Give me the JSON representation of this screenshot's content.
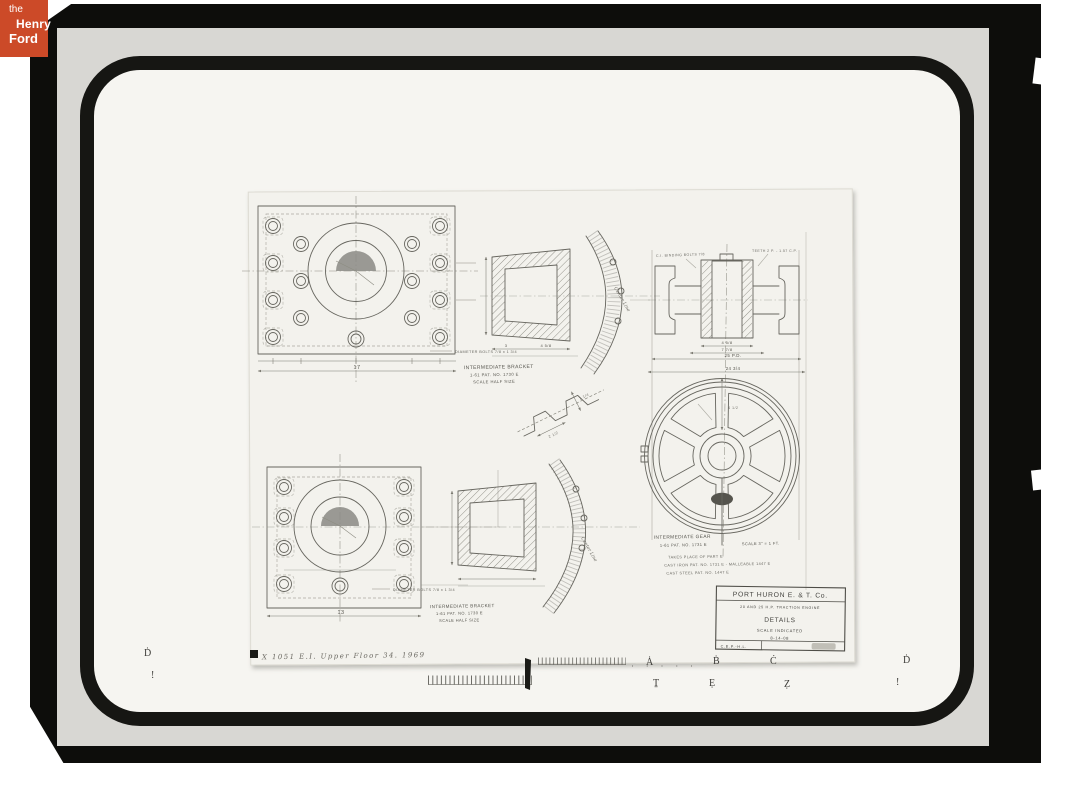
{
  "logo": {
    "the": "the",
    "henry": "Henry",
    "ford": "Ford",
    "bg_color": "#cc4a28",
    "text_color": "#ffffff"
  },
  "colors": {
    "film_black": "#0d0d0b",
    "photo_gray": "#d8d7d3",
    "mat_ring_black": "#161613",
    "sheet_white": "#f3f2ed",
    "ink_gray": "#67665f"
  },
  "drawing": {
    "labels": {
      "bracket_top": {
        "title": "INTERMEDIATE BRACKET",
        "ref": "1-61  PAT. NO. 1730 E",
        "scale": "SCALE HALF SIZE"
      },
      "bracket_bottom": {
        "title": "INTERMEDIATE BRACKET",
        "ref": "1-61  PAT. NO. 1730 E",
        "scale": "SCALE HALF SIZE"
      },
      "gear": {
        "title": "INTERMEDIATE GEAR",
        "ref": "1-61  PAT. NO. 1731 E",
        "scale": "SCALE 3\" = 1 FT.",
        "note1": "TAKES PLACE OF PART E",
        "note2": "CAST IRON PAT. NO. 1731 E  -  MALLEABLE 1447 E",
        "note3": "CAST STEEL PAT. NO. 1447 E"
      },
      "bolts_note_top": "DIAMETER BOLTS 7/8 x 1 3/4",
      "bolts_note_bottom": "DIAMETER BOLTS 7/8 x 1 3/4",
      "center_line_top": "Center Line",
      "center_line_bottom": "Center Line",
      "gear_note_left": "C.I. BINDING BOLTS 7/8",
      "gear_note_right": "TEETH 2 P. - 1.57 C.P."
    },
    "dimensions": {
      "bracket_top_width": "17",
      "bracket_bottom_width": "13",
      "section_depth": "3",
      "section_width": "4 5/8",
      "gear_hub_width": "4 5/8",
      "gear_web_width": "7 7/8",
      "gear_pitch_diameter": "25 P.D.",
      "gear_outside_diameter": "24 3/4",
      "wheel_spoke": "4 1/2",
      "tooth_pitch": "2 1/2",
      "tooth_depth": "1 1/4"
    },
    "title_block": {
      "company": "PORT HURON E. & T. Co.",
      "subtitle": "20 AND 25 H.P. TRACTION ENGINE",
      "title": "DETAILS",
      "scale": "SCALE INDICATED",
      "date": "8-14-08",
      "initials": "C.E.P.-H.L."
    },
    "handwritten_note": "X 1051  E.I.  Upper  Floor  34.  1969"
  },
  "fiducials": {
    "top": [
      "Ḋ",
      "Ȧ",
      "Ḃ",
      "Ċ",
      "Ḋ"
    ],
    "bottom": [
      "!",
      "Ṯ",
      "Ẹ",
      "Ẓ",
      "!"
    ]
  }
}
